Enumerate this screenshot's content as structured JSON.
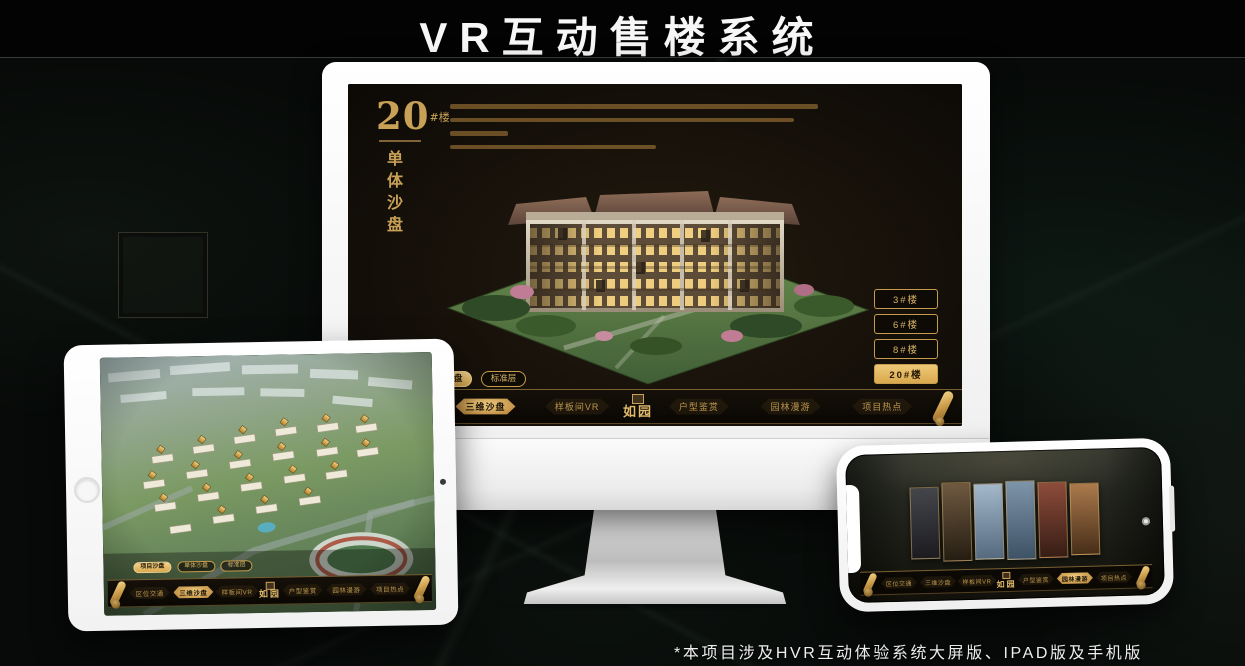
{
  "page": {
    "title": "VR互动售楼系统",
    "footnote": "*本项目涉及HVR互动体验系统大屏版、IPAD版及手机版"
  },
  "colors": {
    "gold": "#d2a85c",
    "gold_bright": "#eec878",
    "screen_bg": "#18120a",
    "active_text": "#241703"
  },
  "monitor": {
    "block_number": "20",
    "block_suffix": "#楼",
    "block_subtitle": "单体沙盘",
    "floor_buttons": [
      {
        "label": "3#楼",
        "active": false
      },
      {
        "label": "6#楼",
        "active": false
      },
      {
        "label": "8#楼",
        "active": false
      },
      {
        "label": "20#楼",
        "active": true
      }
    ],
    "tabs": [
      {
        "label": "项目沙盘",
        "active": false
      },
      {
        "label": "单体沙盘",
        "active": true
      },
      {
        "label": "标准层",
        "active": false
      }
    ],
    "menu": {
      "logo": "如园",
      "items": [
        {
          "label": "区位交通",
          "active": false
        },
        {
          "label": "三维沙盘",
          "active": true
        },
        {
          "label": "样板间VR",
          "active": false
        },
        {
          "label": "户型鉴赏",
          "active": false
        },
        {
          "label": "园林漫游",
          "active": false
        },
        {
          "label": "项目热点",
          "active": false
        }
      ]
    }
  },
  "tablet": {
    "tabs": [
      {
        "label": "项目沙盘",
        "active": true
      },
      {
        "label": "单体沙盘",
        "active": false
      },
      {
        "label": "标准层",
        "active": false
      }
    ],
    "menu": {
      "logo": "如园",
      "items": [
        {
          "label": "区位交通",
          "active": false
        },
        {
          "label": "三维沙盘",
          "active": true
        },
        {
          "label": "样板间VR",
          "active": false
        },
        {
          "label": "户型鉴赏",
          "active": false
        },
        {
          "label": "园林漫游",
          "active": false
        },
        {
          "label": "项目热点",
          "active": false
        }
      ]
    }
  },
  "phone": {
    "menu": {
      "logo": "如园",
      "items": [
        {
          "label": "区位交通",
          "active": false
        },
        {
          "label": "三维沙盘",
          "active": false
        },
        {
          "label": "样板间VR",
          "active": false
        },
        {
          "label": "户型鉴赏",
          "active": false
        },
        {
          "label": "园林漫游",
          "active": true
        },
        {
          "label": "项目热点",
          "active": false
        }
      ]
    }
  }
}
